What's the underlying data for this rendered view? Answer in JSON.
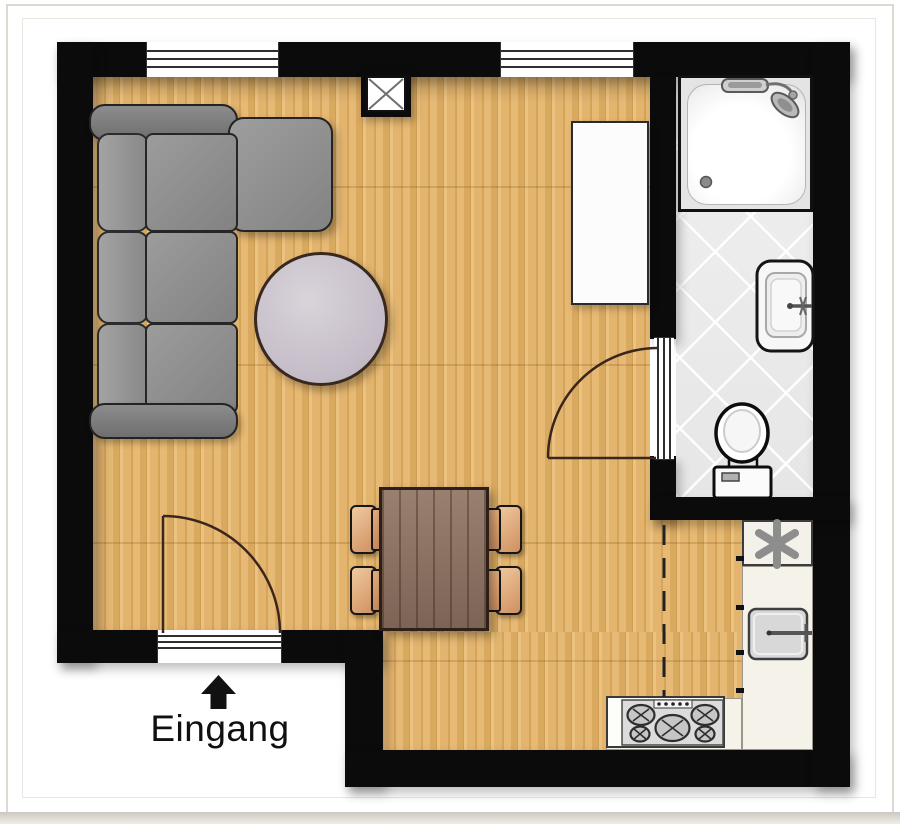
{
  "meta": {
    "type": "apartment-floor-plan",
    "language": "de"
  },
  "entrance": {
    "label": "Eingang",
    "arrow_icon": "arrow-up-icon"
  },
  "colors": {
    "background": "#ffffff",
    "wall": "#0b0b0b",
    "wood_floor": "#deb067",
    "tile_floor": "#ededed",
    "counter": "#f4f2e9",
    "sofa_gray": "#8f8f8f",
    "round_table_lavender": "#c4bcc7",
    "dining_table_brown": "#8d7261",
    "chair_tan": "#cf8f5e",
    "door_arc_brown": "#3c261c"
  },
  "rooms": {
    "living_area": {
      "furniture": [
        "corner-sofa",
        "round-coffee-table",
        "sideboard",
        "dining-table-with-4-chairs"
      ]
    },
    "bathroom": {
      "fixtures": [
        "shower",
        "washbasin",
        "toilet"
      ]
    },
    "kitchen": {
      "fixtures": [
        "refrigerator-marker",
        "kitchen-sink",
        "stove-5-burners"
      ]
    }
  },
  "architecture": [
    "window-top-left",
    "window-top-right",
    "wall-shaft",
    "entrance-door",
    "bathroom-door",
    "kitchen-divider-dashed-line"
  ]
}
